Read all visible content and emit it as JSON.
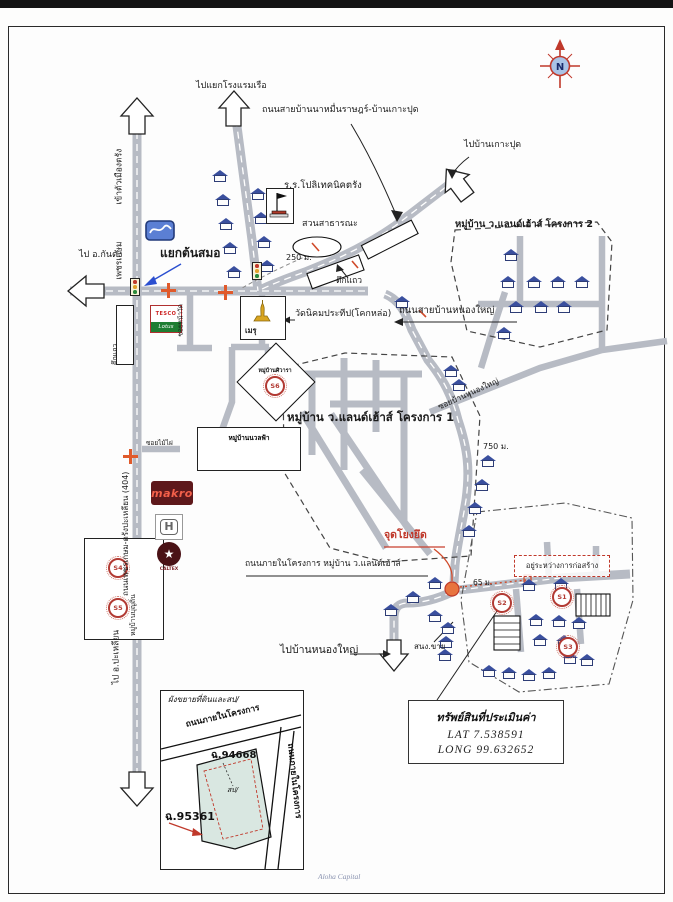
{
  "page": {
    "watermark": "Aloha Capital"
  },
  "compass": {
    "north": "N"
  },
  "labels": {
    "to_boat_hotel_junction": "ไปแยกโรงแรมเรือ",
    "road_banna": "ถนนสายบ้านนาหมื่นราษฎร์-บ้านเกาะปุด",
    "to_ban_kohpud": "ไปบ้านเกาะปุด",
    "school": "ร.ร.โปลิเทคนิคตรัง",
    "park": "สวนสาธารณะ",
    "dist_250": "250 ม.",
    "rowhouses": "ตึกแถว",
    "rowhouses_left": "ตึกแถว",
    "project2": "หมู่บ้าน ว.แลนด์เฮ้าส์ โครงการ 2",
    "to_kantang": "ไป อ.กันตัง",
    "tonsamo_junction": "แยกต้นสมอ",
    "into_city": "เข้าตัวเมืองตรัง",
    "phetkasem": "เพชรเกษม",
    "temple": "วัดนิคมประทีป(โคกหล่อ)",
    "meru": "เมรุ",
    "shiva_village": "หมู่บ้านศิวารา",
    "project1": "หมู่บ้าน ว.แลนด์เฮ้าส์ โครงการ 1",
    "nuanfa_village": "หมู่บ้านนวลฟ้า",
    "soi_temple": "ซอยหน้าวัด",
    "soi_maiphai": "ซอยไม้ไผ่",
    "burin_village": "หมู่บ้านบุญถิ่น",
    "hwy404": "ถนนเพชรเกษม-ตรังปะเหลียน (404)",
    "to_palian": "ไป อ.ปะเหลียน",
    "road_nongyai": "ถนนสายบ้านหนองใหญ่",
    "soi_nongyai": "ซอยบ้านหนองใหญ่",
    "dist_750": "750 ม.",
    "tie_point": "จุดโยงยึด",
    "internal_road": "ถนนภายในโครงการ หมู่บ้าน ว.แลนด์เฮ้าส์",
    "dist_65": "65 ม.",
    "under_construction": "อยู่ระหว่างการก่อสร้าง",
    "sales_office": "สนง.ขาย",
    "to_ban_nongyai": "ไปบ้านหนองใหญ่"
  },
  "markers": {
    "s1": "S1",
    "s2": "S2",
    "s3": "S3",
    "s4": "S4",
    "s5": "S5",
    "s6": "S6"
  },
  "logos": {
    "tesco_line1": "TESCO",
    "tesco_line2": "Lotus",
    "makro": "makro",
    "honda": "H",
    "caltex_star": "★",
    "caltex_name": "CALTEX"
  },
  "property_box": {
    "title": "ทรัพย์สินที่ประเมินค่า",
    "lat": "LAT  7.538591",
    "long": "LONG  99.632652"
  },
  "inset": {
    "title": "ผังขยายที่ดินและสป/",
    "road_top": "ถนนภายในโครงการ",
    "road_right": "ถนนภายในโครงการ",
    "parcel_a": "ฉ.94668",
    "parcel_a_note": "สป/",
    "parcel_b": "ฉ.95361"
  }
}
